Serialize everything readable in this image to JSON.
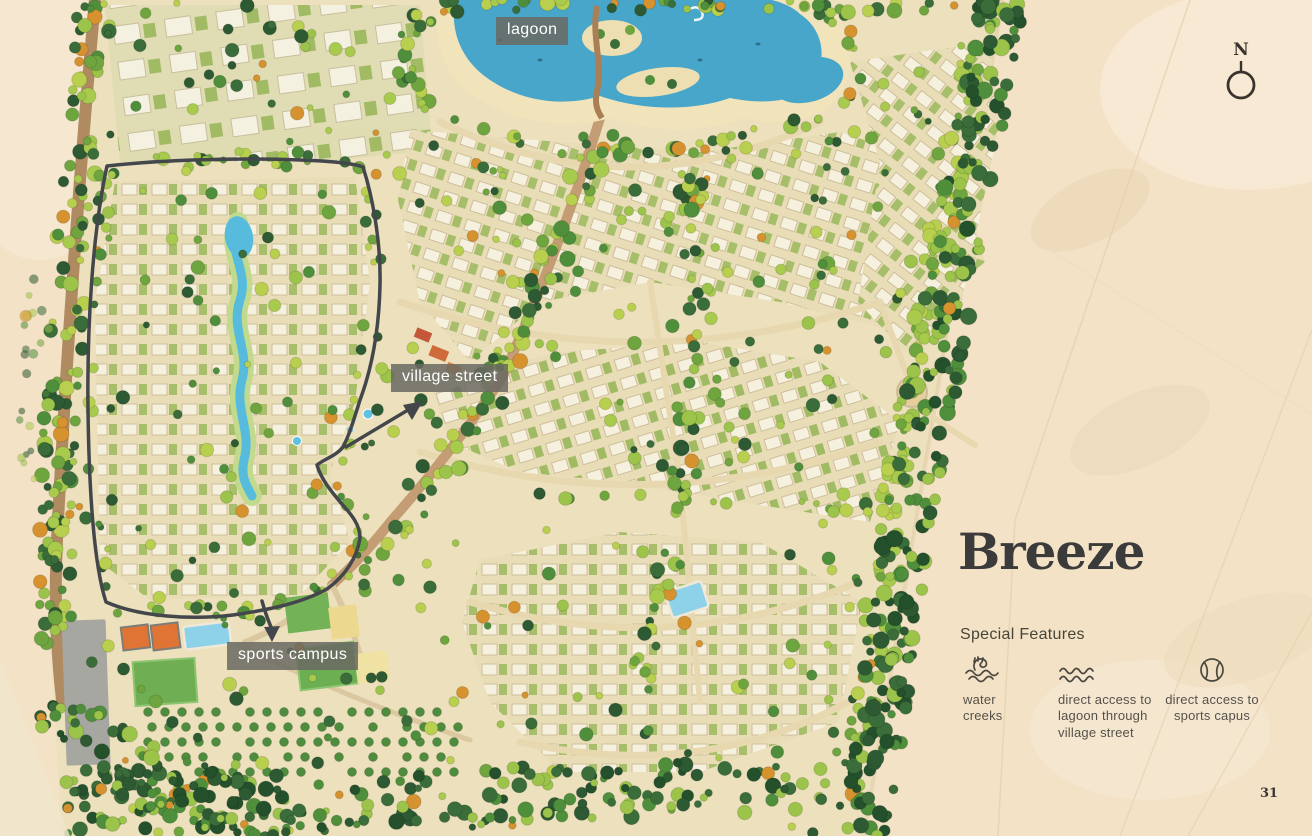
{
  "title": "Breeze",
  "page_number": "31",
  "compass": {
    "north_label": "N"
  },
  "map_labels": {
    "lagoon": "lagoon",
    "village_street": "village street",
    "sports_campus": "sports campus"
  },
  "special_features": {
    "heading": "Special Features",
    "items": [
      {
        "icon": "water-creek-icon",
        "label": "water\ncreeks"
      },
      {
        "icon": "waves-icon",
        "label": "direct access to\nlagoon through\nvillage street"
      },
      {
        "icon": "tennis-ball-icon",
        "label": "direct access to\nsports capus"
      }
    ]
  },
  "colors": {
    "desert_sand": "#f3e2c6",
    "plan_ground": "#ece0bd",
    "lagoon_blue": "#47a6c9",
    "creek_blue": "#56bbdc",
    "tree_dark_green": "#2d5a33",
    "tree_mid_green": "#4f8f3c",
    "tree_light_green": "#9cc44a",
    "tree_lime": "#b9cf4e",
    "tree_orange_accent": "#d6922e",
    "road_tan": "#e8d8b0",
    "road_brown": "#b08a60",
    "boundary_dark": "#43464a",
    "court_orange": "#e07434",
    "pool_blue": "#8ed2ea",
    "field_green": "#6fae52",
    "parking_gray": "#a7a7a1",
    "label_background": "#6a6862",
    "title_text": "#3b3b3b",
    "caption_text": "#55524a"
  }
}
